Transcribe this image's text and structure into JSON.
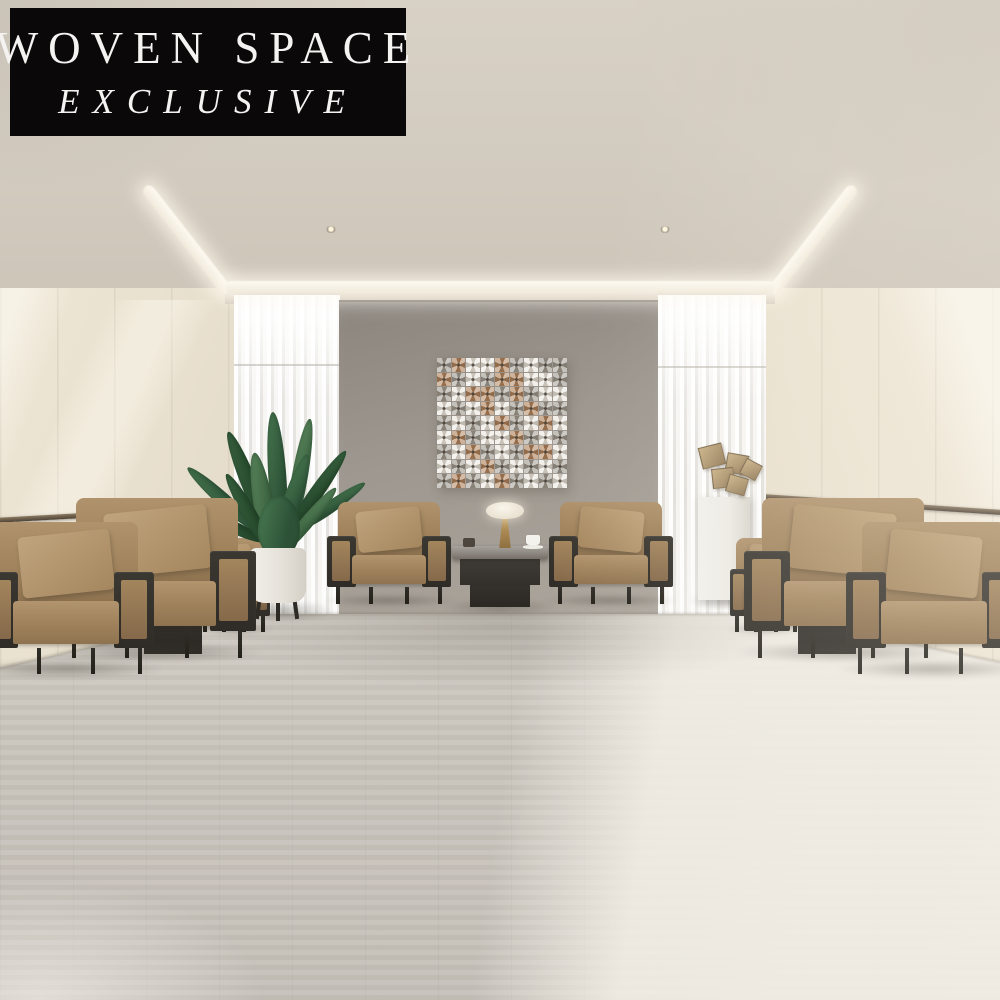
{
  "banner": {
    "line1": "WOVEN SPACE",
    "line2": "EXCLUSIVE",
    "background": "#0a0809",
    "text_color": "#f4f3f1"
  },
  "art": {
    "rows": 9,
    "cols": 9,
    "colors": {
      "w": "#eae6dd",
      "g": "#9a948a",
      "c": "#aa7a50"
    },
    "pattern": [
      "gcwwcgwgg",
      "cgwgccwwg",
      "gwccgcgww",
      "wgwcwgcgg",
      "gwgwcgwcw",
      "wcgwwcgwg",
      "gwcgwgccw",
      "wgwcgwgwg",
      "gcgwcgwgw"
    ]
  },
  "palette": {
    "ceiling": "#d3ccc0",
    "wall_cream": "#ece4d3",
    "accent_wall": "#a09a92",
    "curtain": "#f3f2ef",
    "floor": "#c9c4bc",
    "floor_sunlit": "#e3dfd8",
    "chair_tan": "#a28560",
    "frame_charcoal": "#34312c",
    "brass_trim": "#7a6850",
    "plant_green": "#3c6a45",
    "sculpture_bronze": "#b79a72",
    "cove_light": "#fdfaf2"
  }
}
